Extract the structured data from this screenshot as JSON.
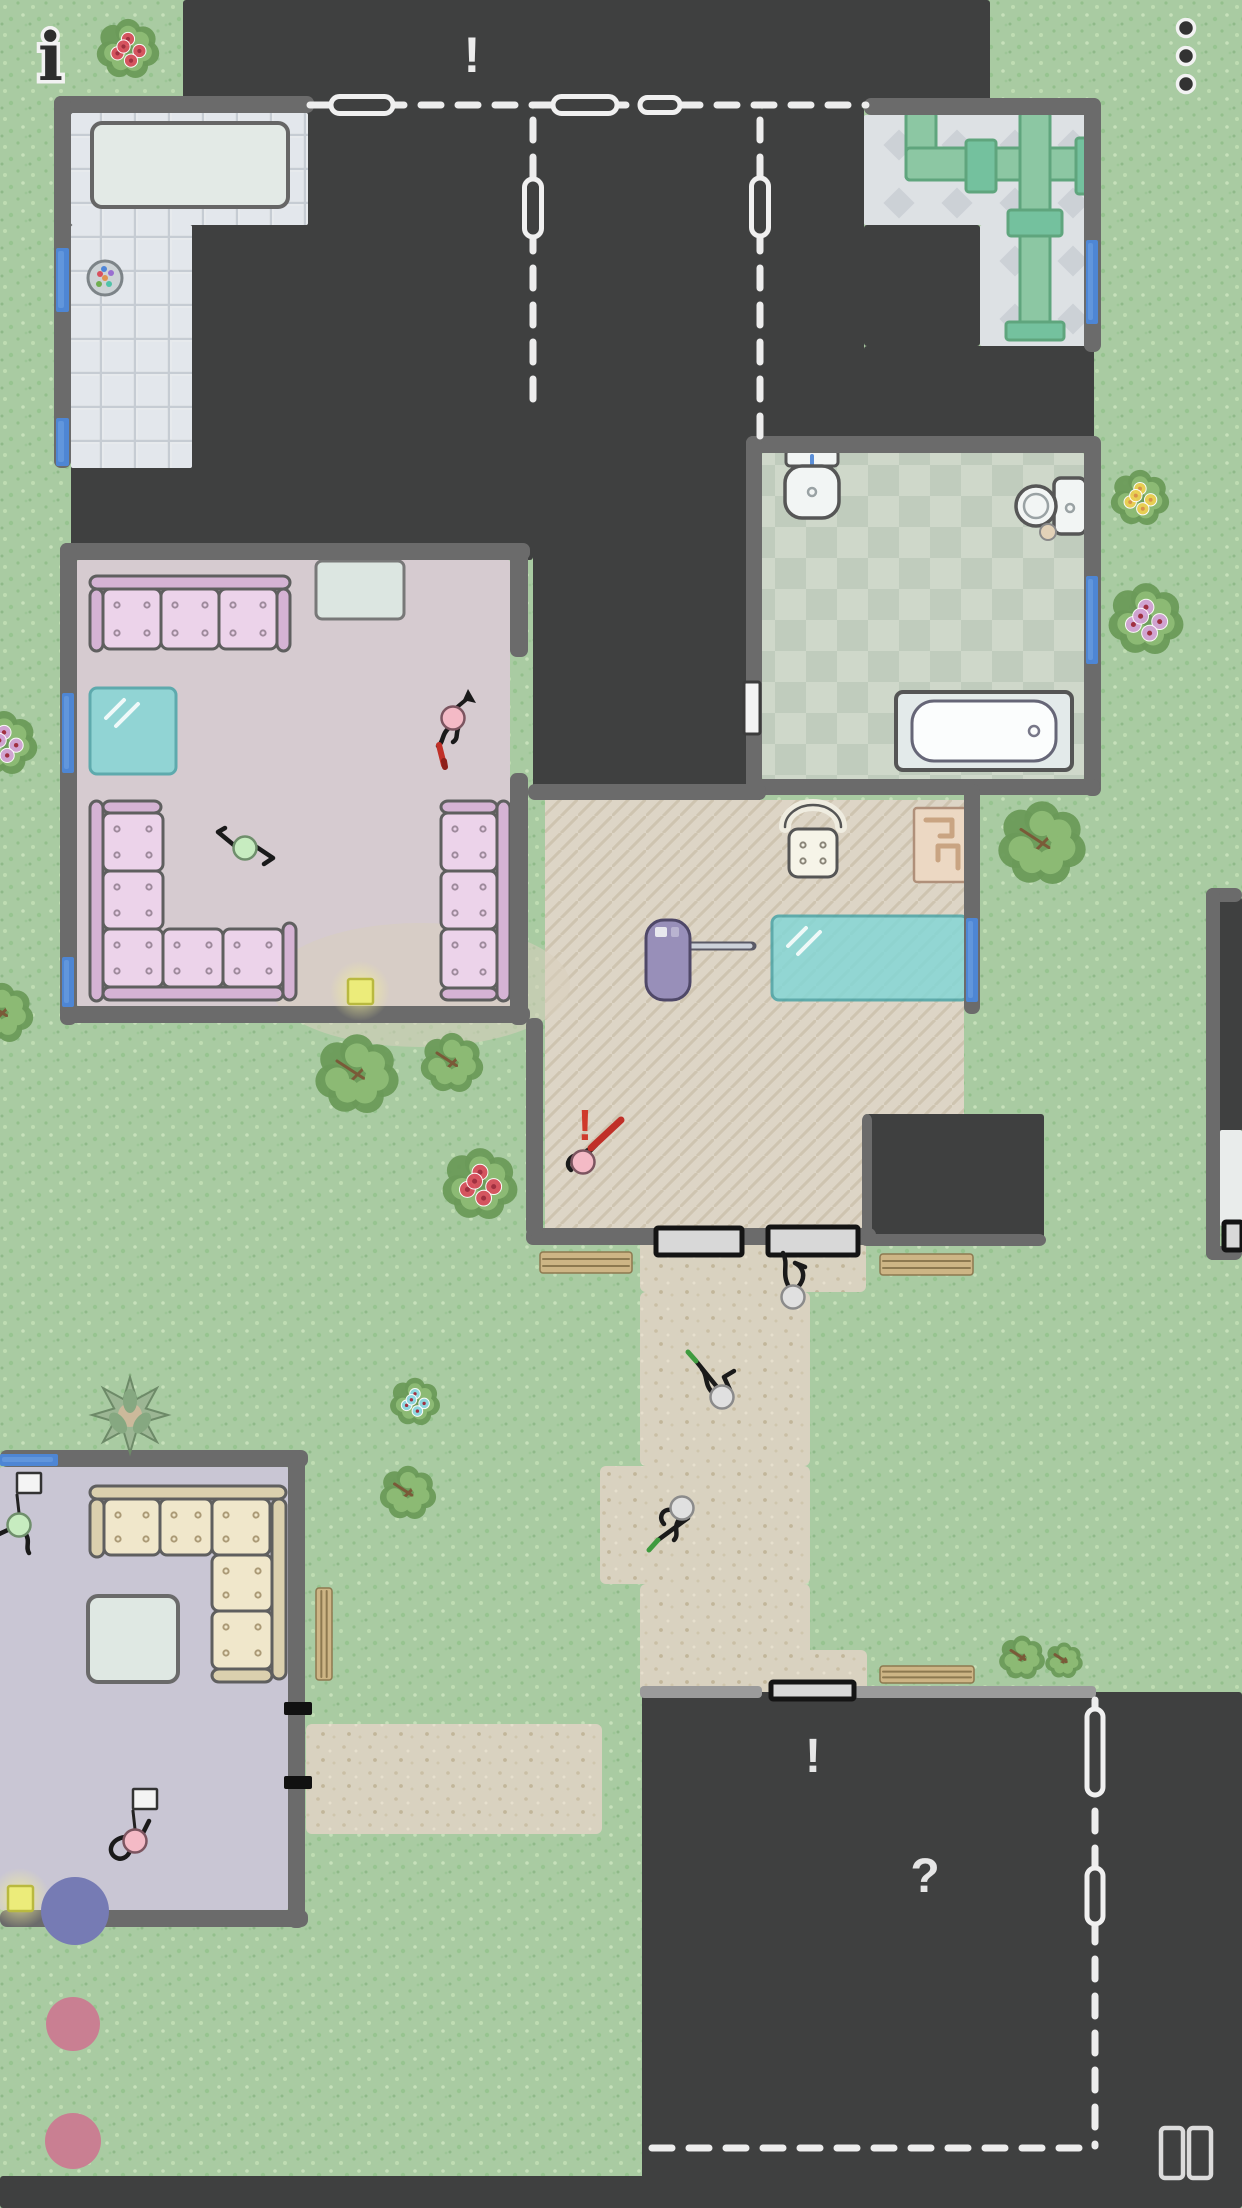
{
  "hud": {
    "info_glyph": "i",
    "menu_dots": 3,
    "pause_bars": 2,
    "colors": {
      "glyph_dark": "#2d2d2d",
      "halo": "#f2f2f2",
      "pause": "#dcdcdc"
    }
  },
  "markers": [
    {
      "name": "alert-top",
      "glyph": "!",
      "x": 472,
      "y": 72,
      "size": 50,
      "color": "#ececec"
    },
    {
      "name": "alert-character",
      "glyph": "!",
      "x": 585,
      "y": 1140,
      "size": 44,
      "color": "#cf3a2c"
    },
    {
      "name": "alert-building",
      "glyph": "!",
      "x": 813,
      "y": 1772,
      "size": 48,
      "color": "#e6e6e6"
    },
    {
      "name": "question-building",
      "glyph": "?",
      "x": 925,
      "y": 1892,
      "size": 48,
      "color": "#e6e6e6"
    }
  ],
  "map": {
    "colors": {
      "grass": "#a9cba2",
      "dark": "#3f4040",
      "wall": "#6b6b6b",
      "wallLight": "#9b9b9b",
      "window": "#4e86d4",
      "windowHi": "#74a6e4",
      "path": "#d9d2c0",
      "livingFloor": "#d6cbd0",
      "livingBeige": "#d9cfbe",
      "lavFloor": "#c9c6d4",
      "pipe": "#8cc7a3",
      "pipeEdge": "#5fa57d",
      "pipeJoint": "#74c19e",
      "couchPink": "#e4c5e2",
      "couchPinkCushion": "#ecd3ea",
      "couchPinkBack": "#d5b3d4",
      "couchDot": "#9e8a9c",
      "couchCream": "#e6dbbc",
      "couchCreamCushion": "#f0e7cb",
      "couchCreamBack": "#dbd0ae",
      "couchCreamDot": "#ab9a76",
      "tableWhite": "#e3eae6",
      "glassTeal": "#82d7d6",
      "glassEdge": "#44a3a6",
      "mat": "#d8d8d8",
      "matEdge": "#141414",
      "bench": "#cdb585",
      "benchLine": "#8d7950",
      "rug": "#ecd8c3",
      "rugLine": "#c9a482",
      "vacuum": "#988fb9",
      "leaf": "#8cba74",
      "leafDark": "#6a9a58",
      "branch": "#7a5a38",
      "flowerRed": "#d8505e",
      "flowerYellow": "#ecd052",
      "flowerViolet": "#d4a3d6",
      "flowerBlue": "#8fd8e4",
      "headPink": "#f4bac6",
      "headGreen": "#c7ecc0",
      "headGray": "#e0e0e0",
      "limb": "#1a1a1a",
      "tokenBlue": "#767bb4",
      "tokenPink": "#c97f92",
      "yellow": "#ecec7a",
      "yellowEdge": "#b9b93f",
      "dash": "#ededed",
      "red": "#c03028",
      "spear": "#3f9b3f",
      "fixture": "#f2f5f4",
      "fixtureEdge": "#565656"
    },
    "dark_regions": [
      [
        183,
        0,
        807,
        107
      ],
      [
        71,
        107,
        462,
        453
      ],
      [
        533,
        107,
        229,
        693
      ],
      [
        762,
        107,
        102,
        346
      ],
      [
        864,
        346,
        230,
        107
      ],
      [
        864,
        225,
        116,
        121
      ],
      [
        866,
        1114,
        178,
        126
      ],
      [
        1206,
        897,
        36,
        235
      ],
      [
        642,
        1692,
        600,
        516
      ],
      [
        0,
        2176,
        1242,
        32
      ]
    ],
    "paths": [
      [
        640,
        1230,
        226,
        62
      ],
      [
        640,
        1292,
        170,
        174
      ],
      [
        600,
        1466,
        210,
        118
      ],
      [
        640,
        1584,
        170,
        108
      ],
      [
        757,
        1650,
        110,
        44
      ],
      [
        306,
        1724,
        296,
        110
      ]
    ],
    "floors": [
      {
        "type": "tile",
        "rects": [
          [
            71,
            113,
            237,
            112
          ],
          [
            71,
            225,
            121,
            243
          ]
        ]
      },
      {
        "type": "diamond",
        "rects": [
          [
            864,
            115,
            230,
            110
          ],
          [
            980,
            225,
            114,
            121
          ]
        ]
      },
      {
        "type": "check",
        "rects": [
          [
            762,
            453,
            322,
            326
          ]
        ]
      },
      {
        "type": "flat",
        "fill": "livingFloor",
        "rects": [
          [
            77,
            560,
            433,
            446
          ]
        ]
      },
      {
        "type": "herr",
        "poly": [
          [
            545,
            800
          ],
          [
            964,
            800
          ],
          [
            964,
            1114
          ],
          [
            866,
            1114
          ],
          [
            866,
            1228
          ],
          [
            545,
            1228
          ]
        ]
      },
      {
        "type": "flat",
        "fill": "lavFloor",
        "rects": [
          [
            0,
            1467,
            288,
            443
          ]
        ]
      },
      {
        "type": "flat",
        "fill": "#e9eceb",
        "rects": [
          [
            1220,
            1130,
            22,
            96
          ]
        ]
      }
    ],
    "beige_patch": {
      "cx": 420,
      "cy": 985,
      "rx": 150,
      "ry": 62
    },
    "walls": [
      [
        54,
        96,
        260,
        17
      ],
      [
        54,
        96,
        17,
        372
      ],
      [
        864,
        98,
        236,
        17
      ],
      [
        1084,
        98,
        17,
        254
      ],
      [
        746,
        436,
        354,
        17
      ],
      [
        746,
        436,
        16,
        360
      ],
      [
        1084,
        436,
        17,
        360
      ],
      [
        746,
        779,
        354,
        16
      ],
      [
        528,
        784,
        238,
        16
      ],
      [
        964,
        784,
        16,
        230
      ],
      [
        526,
        1228,
        350,
        17
      ],
      [
        60,
        543,
        470,
        17
      ],
      [
        60,
        543,
        17,
        482
      ],
      [
        60,
        1006,
        470,
        17
      ],
      [
        510,
        543,
        18,
        114
      ],
      [
        510,
        773,
        18,
        252
      ],
      [
        526,
        1018,
        17,
        218
      ],
      [
        0,
        1450,
        308,
        17
      ],
      [
        288,
        1450,
        17,
        478
      ],
      [
        0,
        1910,
        308,
        17
      ],
      [
        1206,
        888,
        36,
        14
      ],
      [
        1206,
        888,
        14,
        372
      ],
      [
        1206,
        1246,
        36,
        14
      ],
      [
        862,
        1114,
        10,
        130
      ],
      [
        860,
        1234,
        186,
        12
      ]
    ],
    "light_walls": [
      [
        640,
        1686,
        122,
        12
      ],
      [
        854,
        1686,
        242,
        12
      ]
    ],
    "windows": [
      [
        56,
        248,
        13,
        64
      ],
      [
        56,
        418,
        13,
        48
      ],
      [
        1086,
        240,
        12,
        84
      ],
      [
        1086,
        576,
        12,
        88
      ],
      [
        62,
        693,
        12,
        80
      ],
      [
        62,
        957,
        12,
        50
      ],
      [
        966,
        918,
        12,
        84
      ],
      [
        0,
        1454,
        58,
        12
      ]
    ],
    "white_doors": [
      [
        744,
        682,
        16,
        52
      ]
    ],
    "black_door_ticks": [
      [
        284,
        1702,
        28,
        13
      ],
      [
        284,
        1776,
        28,
        13
      ]
    ],
    "dashed_lines": [
      {
        "x1": 310,
        "y1": 105,
        "x2": 866,
        "y2": 105
      },
      {
        "x1": 533,
        "y1": 120,
        "x2": 533,
        "y2": 402
      },
      {
        "x1": 760,
        "y1": 120,
        "x2": 760,
        "y2": 440
      },
      {
        "x1": 1095,
        "y1": 1700,
        "x2": 1095,
        "y2": 2146
      },
      {
        "x1": 652,
        "y1": 2148,
        "x2": 1088,
        "y2": 2148
      }
    ],
    "door_pills": [
      {
        "x": 362,
        "y": 105,
        "w": 62,
        "h": 17
      },
      {
        "x": 585,
        "y": 105,
        "w": 64,
        "h": 17
      },
      {
        "x": 660,
        "y": 105,
        "w": 40,
        "h": 15
      },
      {
        "x": 533,
        "y": 208,
        "w": 17,
        "h": 58
      },
      {
        "x": 760,
        "y": 207,
        "w": 17,
        "h": 58
      },
      {
        "x": 1095,
        "y": 1752,
        "w": 16,
        "h": 86
      },
      {
        "x": 1095,
        "y": 1896,
        "w": 16,
        "h": 56
      }
    ],
    "mats": [
      [
        656,
        1228,
        86,
        27
      ],
      [
        768,
        1227,
        90,
        28
      ],
      [
        771,
        1682,
        83,
        17
      ],
      [
        1224,
        1222,
        18,
        28
      ]
    ],
    "benches": [
      {
        "x": 540,
        "y": 1252,
        "w": 92,
        "h": 21,
        "o": "h"
      },
      {
        "x": 880,
        "y": 1254,
        "w": 93,
        "h": 21,
        "o": "h"
      },
      {
        "x": 880,
        "y": 1666,
        "w": 94,
        "h": 17,
        "o": "h"
      },
      {
        "x": 316,
        "y": 1588,
        "w": 16,
        "h": 92,
        "o": "v"
      }
    ],
    "bushes": [
      {
        "x": 128,
        "y": 48,
        "r": 30,
        "type": "red"
      },
      {
        "x": 4,
        "y": 742,
        "r": 32,
        "type": "violet"
      },
      {
        "x": 1140,
        "y": 497,
        "r": 28,
        "type": "yellow"
      },
      {
        "x": 1146,
        "y": 618,
        "r": 36,
        "type": "violet"
      },
      {
        "x": 1042,
        "y": 842,
        "r": 42,
        "type": "green"
      },
      {
        "x": 357,
        "y": 1073,
        "r": 40,
        "type": "green"
      },
      {
        "x": 452,
        "y": 1062,
        "r": 30,
        "type": "plain"
      },
      {
        "x": 480,
        "y": 1183,
        "r": 36,
        "type": "red"
      },
      {
        "x": 415,
        "y": 1401,
        "r": 24,
        "type": "blue"
      },
      {
        "x": 408,
        "y": 1492,
        "r": 27,
        "type": "green"
      },
      {
        "x": 2,
        "y": 1012,
        "r": 30,
        "type": "plain"
      },
      {
        "x": 1022,
        "y": 1657,
        "r": 22,
        "type": "green"
      },
      {
        "x": 1064,
        "y": 1660,
        "r": 18,
        "type": "plain"
      }
    ],
    "star_plant": {
      "x": 130,
      "y": 1415,
      "r": 38
    },
    "furniture": {
      "kitchen_table": {
        "x": 92,
        "y": 123,
        "w": 196,
        "h": 84
      },
      "plate": {
        "x": 105,
        "y": 278,
        "r": 17
      },
      "cabinet": {
        "x": 316,
        "y": 561,
        "w": 88,
        "h": 58
      },
      "white_table_bl": {
        "x": 88,
        "y": 1596,
        "w": 90,
        "h": 86
      },
      "glass_tables": [
        {
          "x": 90,
          "y": 688,
          "w": 86,
          "h": 86
        },
        {
          "x": 772,
          "y": 916,
          "w": 196,
          "h": 84
        }
      ],
      "pipes": [
        [
          906,
          112,
          30,
          68
        ],
        [
          906,
          148,
          180,
          32
        ],
        [
          1020,
          112,
          30,
          226
        ]
      ],
      "pipe_joints": [
        [
          966,
          140,
          30,
          52
        ],
        [
          1076,
          138,
          18,
          56
        ],
        [
          1008,
          210,
          54,
          26
        ],
        [
          1006,
          322,
          58,
          18
        ]
      ],
      "sink": {
        "x": 812,
        "y": 486
      },
      "toilet": {
        "x": 1036,
        "y": 506
      },
      "tub": {
        "x": 896,
        "y": 692,
        "w": 176,
        "h": 78
      },
      "rug": {
        "x": 914,
        "y": 808,
        "w": 54,
        "h": 74
      },
      "phone_chair": {
        "x": 813,
        "y": 843
      },
      "vacuum": {
        "x": 646,
        "y": 920
      },
      "couches": [
        {
          "name": "pink-sofa-top",
          "scheme": "pink",
          "parts": [
            [
              "back",
              90,
              576,
              200,
              13
            ],
            [
              "arm",
              90,
              589,
              13,
              62
            ],
            [
              "arm",
              277,
              589,
              13,
              62
            ],
            [
              "cush",
              103,
              589,
              58,
              60
            ],
            [
              "cush",
              161,
              589,
              58,
              60
            ],
            [
              "cush",
              219,
              589,
              58,
              60
            ]
          ]
        },
        {
          "name": "pink-sofa-L",
          "scheme": "pink",
          "parts": [
            [
              "back",
              90,
              801,
              13,
              200
            ],
            [
              "arm",
              103,
              801,
              58,
              12
            ],
            [
              "back",
              103,
              987,
              180,
              13
            ],
            [
              "arm",
              283,
              923,
              13,
              77
            ],
            [
              "cush",
              103,
              813,
              60,
              58
            ],
            [
              "cush",
              103,
              871,
              60,
              58
            ],
            [
              "cush",
              103,
              929,
              60,
              58
            ],
            [
              "cush",
              163,
              929,
              60,
              58
            ],
            [
              "cush",
              223,
              929,
              60,
              58
            ]
          ]
        },
        {
          "name": "pink-sofa-right",
          "scheme": "pink",
          "parts": [
            [
              "back",
              497,
              801,
              13,
              200
            ],
            [
              "arm",
              441,
              801,
              56,
              12
            ],
            [
              "arm",
              441,
              988,
              56,
              12
            ],
            [
              "cush",
              441,
              813,
              56,
              58
            ],
            [
              "cush",
              441,
              871,
              56,
              58
            ],
            [
              "cush",
              441,
              929,
              56,
              59
            ]
          ]
        },
        {
          "name": "cream-sofa-L",
          "scheme": "cream",
          "parts": [
            [
              "back",
              90,
              1486,
              196,
              13
            ],
            [
              "arm",
              90,
              1499,
              14,
              58
            ],
            [
              "back",
              272,
              1499,
              14,
              180
            ],
            [
              "arm",
              212,
              1669,
              60,
              13
            ],
            [
              "cush",
              104,
              1499,
              56,
              56
            ],
            [
              "cush",
              160,
              1499,
              52,
              56
            ],
            [
              "cush",
              212,
              1499,
              58,
              56
            ],
            [
              "cush",
              212,
              1555,
              60,
              56
            ],
            [
              "cush",
              212,
              1611,
              60,
              58
            ]
          ]
        }
      ]
    },
    "items": {
      "yellow_squares": [
        [
          348,
          979
        ],
        [
          8,
          1886
        ]
      ],
      "tokens": [
        {
          "x": 75,
          "y": 1911,
          "r": 34,
          "color": "blue"
        },
        {
          "x": 73,
          "y": 2024,
          "r": 27,
          "color": "pink"
        },
        {
          "x": 73,
          "y": 2141,
          "r": 28,
          "color": "pink"
        }
      ]
    },
    "characters": [
      {
        "name": "resident-pink-livingroom",
        "x": 453,
        "y": 718,
        "head": "pink",
        "limbs": "M -3,9 C -12,16 -9,24 -15,28 M 6,8 C 2,16 6,20 0,24",
        "item": "redstick",
        "arrow": true
      },
      {
        "name": "resident-green-livingroom",
        "x": 245,
        "y": 848,
        "head": "green",
        "limbs": "M -10,-2 L -27,-16 M -27,-16 L -20,-20 M 10,-2 L 28,10 M 28,10 L 19,16",
        "item": null
      },
      {
        "name": "burglar-pink-hallway",
        "x": 583,
        "y": 1162,
        "head": "pink",
        "limbs": "M -7,-7 C -16,-4 -17,4 -12,8 M 5,-9 L 13,-17",
        "item": "crowbar"
      },
      {
        "name": "visitor-at-door",
        "x": 793,
        "y": 1297,
        "head": "gray",
        "limbs": "M -4,-10 C -12,-24 -4,-32 -10,-44 M 5,-10 C 14,-20 10,-30 2,-34 M 2,-34 L 12,-30",
        "item": null
      },
      {
        "name": "guard-spear-upper",
        "x": 722,
        "y": 1397,
        "head": "gray",
        "limbs": "M -9,-4 C -18,-12 -14,-22 -20,-28 M 8,-7 L 2,-20 L 12,-26",
        "item": "spear-nw"
      },
      {
        "name": "guard-spear-lower",
        "x": 682,
        "y": 1508,
        "head": "gray",
        "limbs": "M -10,2 C -20,0 -24,10 -18,16 M -2,10 C -10,20 -2,26 -8,32",
        "item": "spear-sw"
      },
      {
        "name": "flag-green-house2",
        "x": 19,
        "y": 1525,
        "head": "green",
        "limbs": "M -9,4 L -22,10 M 6,8 C 12,16 6,22 10,28",
        "item": "flag"
      },
      {
        "name": "flag-pink-house2",
        "x": 135,
        "y": 1841,
        "head": "pink",
        "limbs": "M -10,-4 C -24,-2 -28,10 -20,16 C -14,20 -8,16 -6,12 M 8,-8 L 14,-20",
        "item": "flag"
      }
    ]
  }
}
